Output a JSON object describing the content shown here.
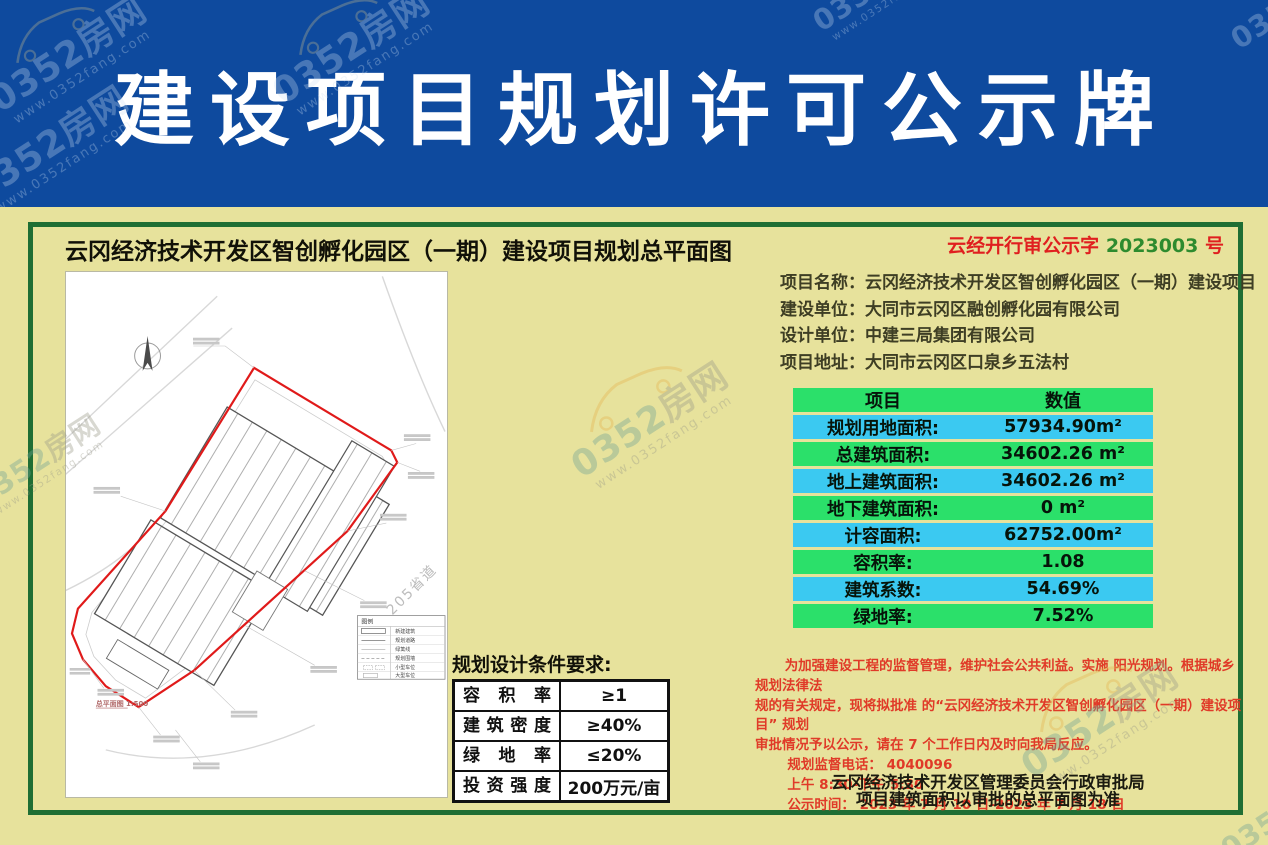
{
  "banner": {
    "title": "建设项目规划许可公示牌"
  },
  "watermark": {
    "brand1": "0352",
    "brand2": "房网",
    "url": "www.0352fang.com"
  },
  "panel": {
    "title": "云冈经济技术开发区智创孵化园区（一期）建设项目规划总平面图",
    "doc_number": {
      "prefix": "云经开行审公示字",
      "number": "2023003",
      "suffix": "号"
    },
    "info": [
      {
        "label": "项目名称：",
        "value": "云冈经济技术开发区智创孵化园区（一期）建设项目"
      },
      {
        "label": "建设单位：",
        "value": "大同市云冈区融创孵化园有限公司"
      },
      {
        "label": "设计单位：",
        "value": "中建三局集团有限公司"
      },
      {
        "label": "项目地址：",
        "value": "大同市云冈区口泉乡五法村"
      }
    ],
    "value_table": {
      "header": {
        "item": "项目",
        "value": "数值"
      },
      "rows": [
        {
          "label": "规划用地面积:",
          "value": "57934.90m²"
        },
        {
          "label": "总建筑面积:",
          "value": "34602.26 m²"
        },
        {
          "label": "地上建筑面积:",
          "value": "34602.26 m²"
        },
        {
          "label": "地下建筑面积:",
          "value": "0 m²"
        },
        {
          "label": "计容面积:",
          "value": "62752.00m²"
        },
        {
          "label": "容积率:",
          "value": "1.08"
        },
        {
          "label": "建筑系数:",
          "value": "54.69%"
        },
        {
          "label": "绿地率:",
          "value": "7.52%"
        }
      ]
    },
    "conditions": {
      "title": "规划设计条件要求:",
      "rows": [
        {
          "label": "容积率",
          "value": "≥1"
        },
        {
          "label": "建筑密度",
          "value": "≥40%"
        },
        {
          "label": "绿地率",
          "value": "≤20%"
        },
        {
          "label": "投资强度",
          "value": "200万元/亩"
        }
      ]
    },
    "notice": {
      "lines": [
        "为加强建设工程的监督管理，维护社会公共利益。实施 阳光规划。根据城乡规划法律法",
        "规的有关规定，现将拟批准 的“云冈经济技术开发区智创孵化园区（一期）建设项目” 规划",
        "审批情况予以公示，请在 7 个工作日内及时向我局反应。",
        "规划监督电话： 4040096",
        "上午 8:30-下午 5:30",
        "公示时间： 2023 年 7 月 10 日-2023 年 7 月 18 日"
      ]
    },
    "signature": [
      "云冈经济技术开发区管理委员会行政审批局",
      "项目建筑面积以审批的总平面图为准"
    ],
    "plan": {
      "road_label": "205省道",
      "caption": "总平面图 1:500",
      "legend": {
        "title": "图例",
        "items": [
          "新建建筑",
          "规划道路",
          "绿篱线",
          "规划围墙",
          "小型车位",
          "大型车位"
        ]
      }
    }
  },
  "colors": {
    "banner_blue": "#0e4a9e",
    "frame_green": "#1f6e34",
    "row_green": "#2be06a",
    "row_cyan": "#3bc9f1",
    "accent_red": "#e03a28",
    "doc_number_green": "#2e8b2e",
    "site_boundary_red": "#e01a1a"
  }
}
